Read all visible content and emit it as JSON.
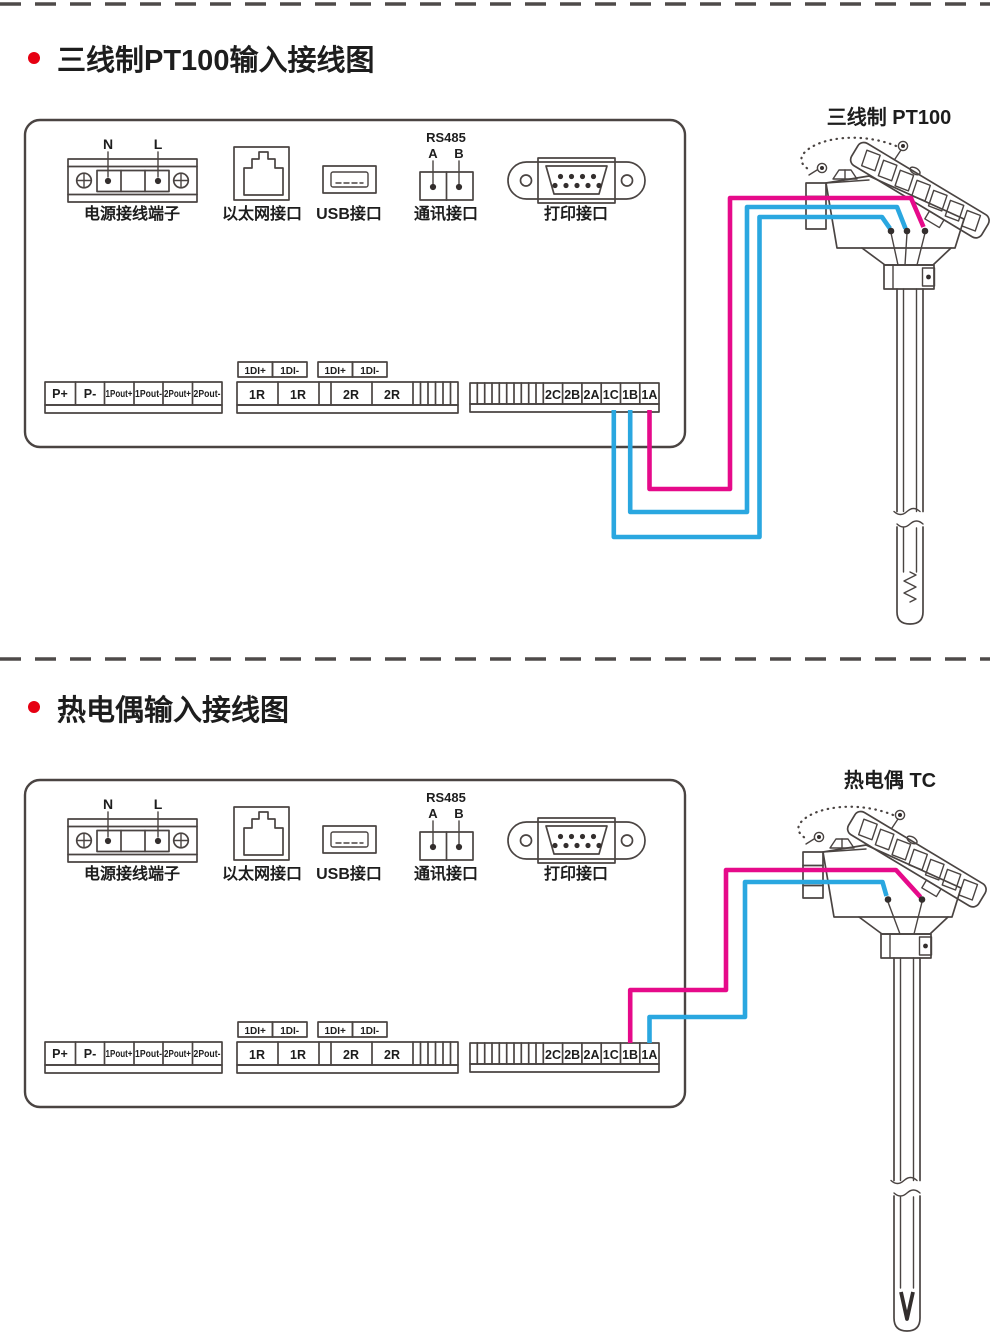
{
  "colors": {
    "line": "#4a4442",
    "text": "#1d1d1d",
    "wire_pink": "#e60a8a",
    "wire_cyan": "#2aa7e0",
    "bullet": "#e60012"
  },
  "sections": [
    {
      "title": "三线制PT100输入接线图",
      "sensor_label": "三线制 PT100",
      "sensor_type": "三线制 PT100",
      "connections": [
        {
          "recorder_terminal": "1A",
          "wire_color": "#e60a8a"
        },
        {
          "recorder_terminal": "1B",
          "wire_color": "#2aa7e0"
        },
        {
          "recorder_terminal": "1C",
          "wire_color": "#2aa7e0"
        }
      ]
    },
    {
      "title": "热电偶输入接线图",
      "sensor_label": "热电偶 TC",
      "sensor_type": "热电偶 TC",
      "connections": [
        {
          "recorder_terminal": "1B",
          "wire_color": "#e60a8a"
        },
        {
          "recorder_terminal": "1A",
          "wire_color": "#2aa7e0"
        }
      ]
    }
  ],
  "panel": {
    "power_port": {
      "label": "电源接线端子",
      "pins": [
        "N",
        "L"
      ]
    },
    "ethernet_port": {
      "label": "以太网接口"
    },
    "usb_port": {
      "label": "USB接口"
    },
    "comm_port": {
      "label": "通讯接口",
      "bus": "RS485",
      "pins": [
        "A",
        "B"
      ]
    },
    "printer_port": {
      "label": "打印接口"
    },
    "strips": {
      "power_out_cells": [
        "P+",
        "P-",
        "1Pout+",
        "1Pout-",
        "2Pout+",
        "2Pout-"
      ],
      "di_labels": [
        "1DI+",
        "1DI-",
        "1DI+",
        "1DI-"
      ],
      "relay_cells": [
        "1R",
        "1R",
        "2R",
        "2R"
      ],
      "input_cells": [
        "2C",
        "2B",
        "2A",
        "1C",
        "1B",
        "1A"
      ]
    }
  }
}
